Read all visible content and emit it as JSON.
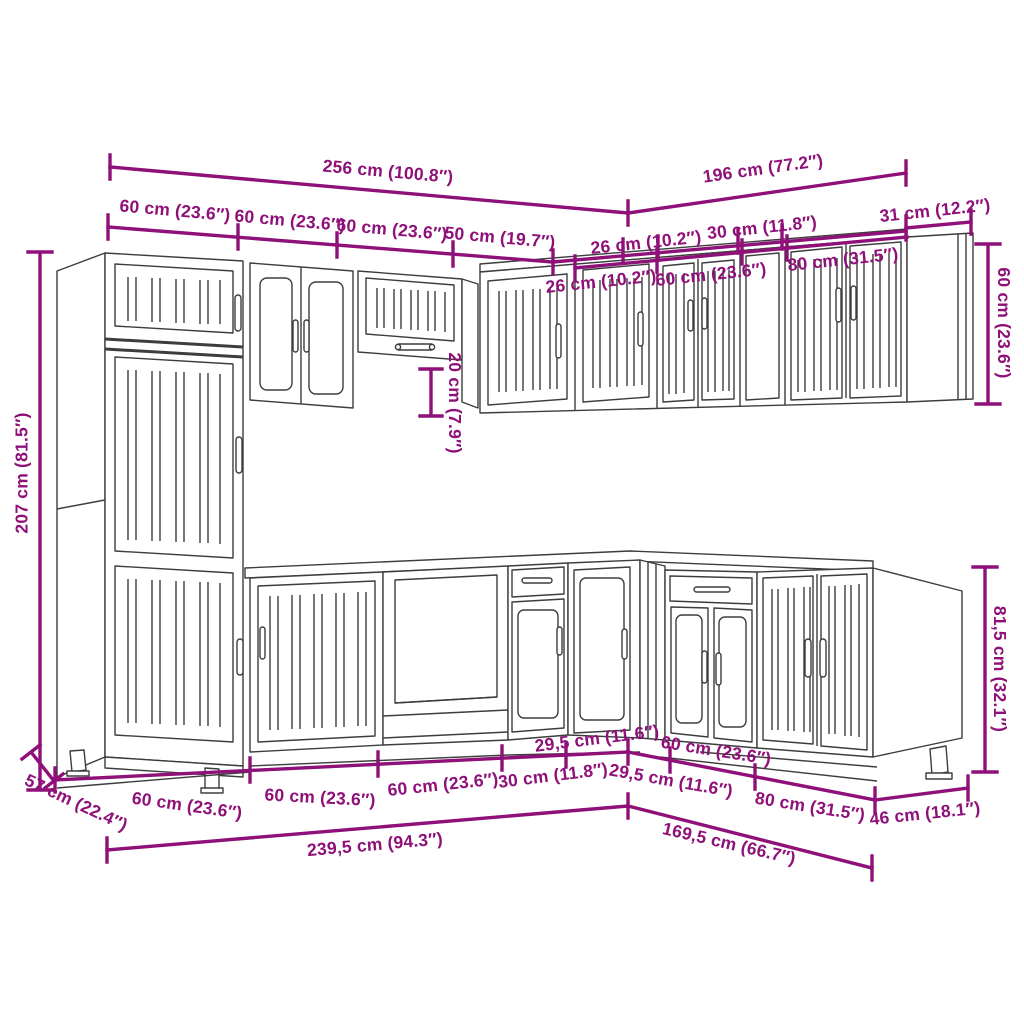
{
  "diagram": {
    "type": "kitchen-cabinet-set-dimension-diagram",
    "accent_color": "#8E1078",
    "line_color": "#3d3d3d",
    "labels": {
      "top_total_left": "256 cm (100.8″)",
      "top_total_right": "196 cm (77.2″)",
      "top_unit_1": "60 cm (23.6″)",
      "top_unit_2": "60 cm (23.6″)",
      "top_unit_3": "60 cm (23.6″)",
      "top_unit_4": "50 cm (19.7″)",
      "top_unit_5": "26 cm (10.2″)",
      "top_unit_6": "30 cm (11.8″)",
      "top_unit_7": "31 cm (12.2″)",
      "wall_right_depth": "26 cm (10.2″)",
      "wall_right_unit_60": "60 cm (23.6″)",
      "wall_right_unit_80": "80 cm (31.5″)",
      "tall_cabinet_height": "207 cm (81.5″)",
      "hood_gap_height": "20 cm (7.9″)",
      "wall_cabinet_height": "60 cm (23.6″)",
      "base_cabinet_height": "81,5 cm (32.1″)",
      "base_depth_left": "57 cm (22.4″)",
      "base_unit_1": "60 cm (23.6″)",
      "base_unit_2": "60 cm (23.6″)",
      "base_unit_3": "60 cm (23.6″)",
      "base_unit_4": "30 cm (11.8″)",
      "base_unit_5": "29,5 cm (11.6″)",
      "base_unit_6": "29,5 cm (11.6″)",
      "base_unit_7": "60 cm (23.6″)",
      "base_unit_8": "80 cm (31.5″)",
      "base_depth_right": "46 cm (18.1″)",
      "bottom_total_left": "239,5 cm (94.3″)",
      "bottom_total_right": "169,5 cm (66.7″)"
    }
  }
}
